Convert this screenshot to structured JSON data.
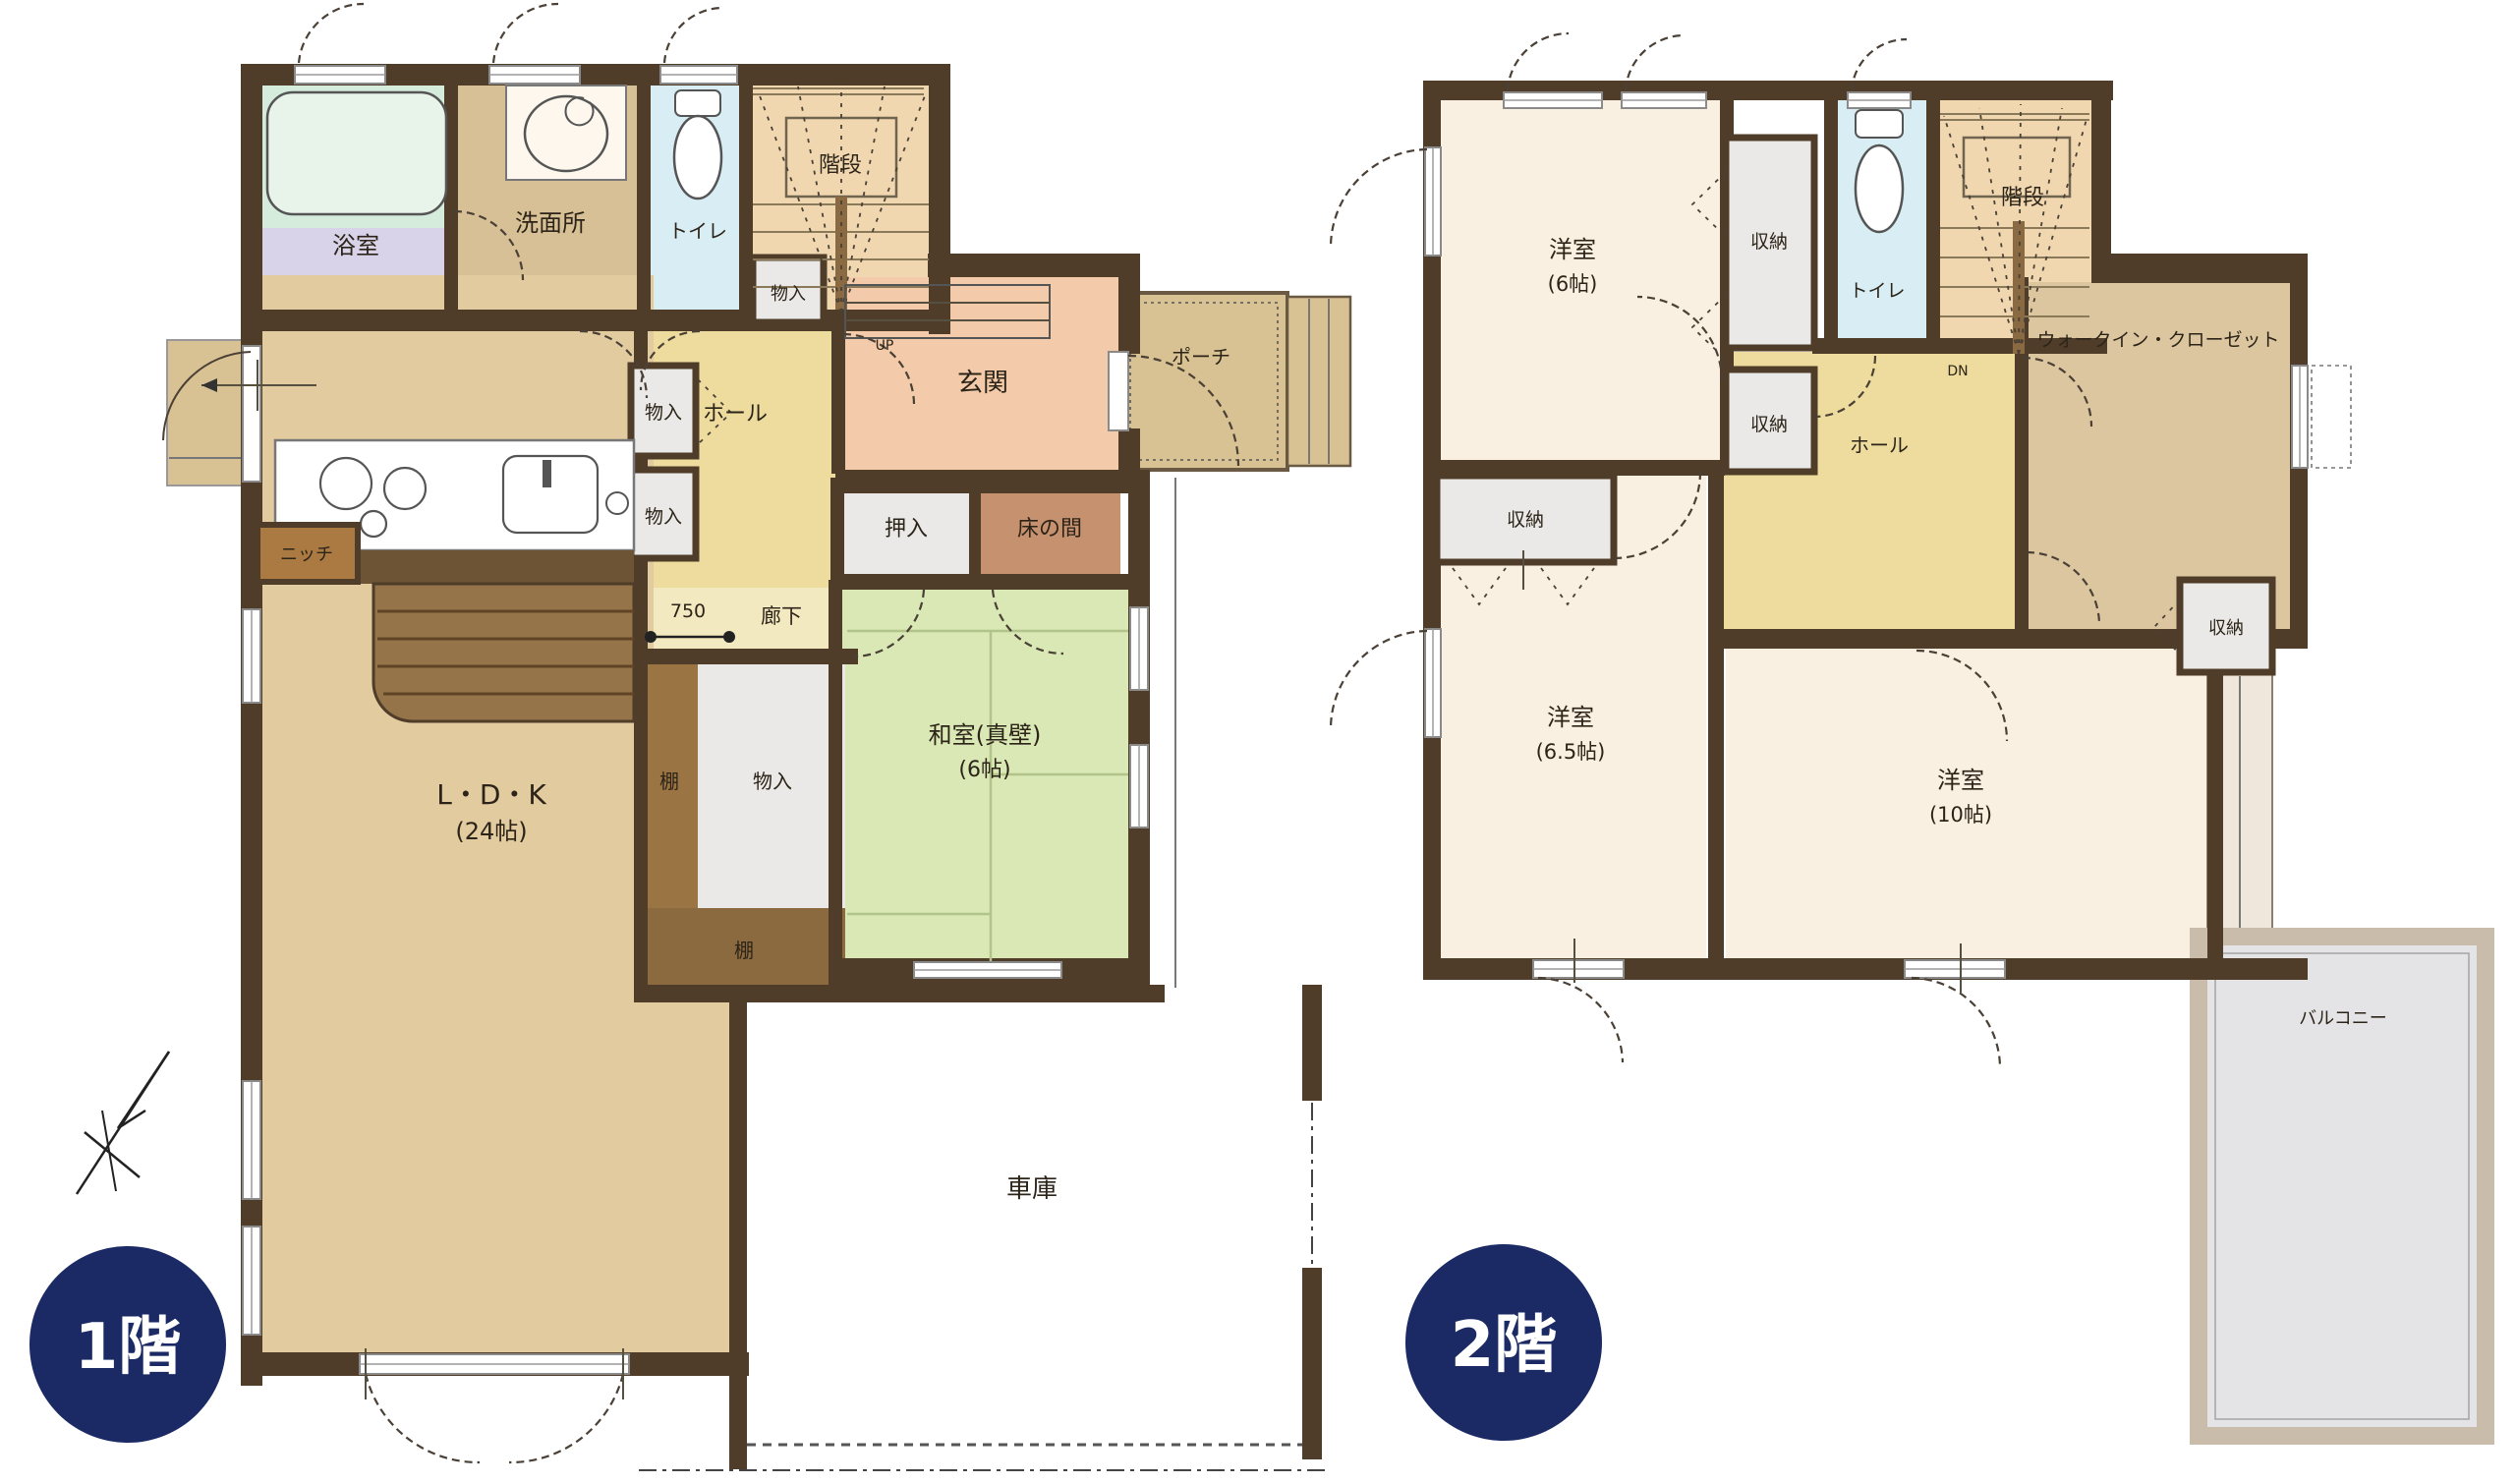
{
  "badges": {
    "floor1": "1階",
    "floor2": "2階"
  },
  "labels": {
    "bathroom": "浴室",
    "washroom": "洗面所",
    "toilet": "トイレ",
    "stairs": "階段",
    "storage_small": "物入",
    "closet": "収納",
    "hall": "ホール",
    "entrance": "玄関",
    "porch": "ポーチ",
    "oshiire": "押入",
    "tokonoma": "床の間",
    "niche": "ニッチ",
    "corridor": "廊下",
    "dim750": "750",
    "shelf": "棚",
    "up": "UP",
    "dn": "DN",
    "ldk": "L・D・K",
    "ldk_size": "(24帖)",
    "washitsu": "和室(真壁)",
    "washitsu_size": "(6帖)",
    "garage": "車庫",
    "yoshitsu": "洋室",
    "size6": "(6帖)",
    "size65": "(6.5帖)",
    "size10": "(10帖)",
    "wic": "ウォークイン・クローゼット",
    "balcony": "バルコニー"
  },
  "colors": {
    "wall": "#4f3d2a",
    "badge": "#1b2a64",
    "badge_text": "#ffffff",
    "ldk_floor": "#e2cb9f",
    "washroom_floor": "#d8c096",
    "bath_floor": "#d8d3e9",
    "bath_band": "#d5ebdb",
    "tub": "#e8f3ea",
    "toilet_floor": "#d8eef4",
    "stairs_floor": "#f0d7b0",
    "hall_floor": "#eddc9e",
    "corridor_floor": "#f3e9c0",
    "storage_floor": "#eae9e7",
    "entrance_floor": "#f4cbaa",
    "porch_floor": "#d8c193",
    "tokonoma_floor": "#c6916f",
    "washitsu_floor": "#d9e8b5",
    "shelf": "#9b7443",
    "shelf_dark": "#8b6a3f",
    "niche": "#aa7a42",
    "counter_front": "#6d5435",
    "bench_wood": "#96744a",
    "bedroom_floor": "#faf0e1",
    "wic_floor": "#dcc69f",
    "strip_floor": "#efe7db",
    "balcony_wall": "#c9bcab",
    "balcony_floor": "#e4e4e6"
  }
}
